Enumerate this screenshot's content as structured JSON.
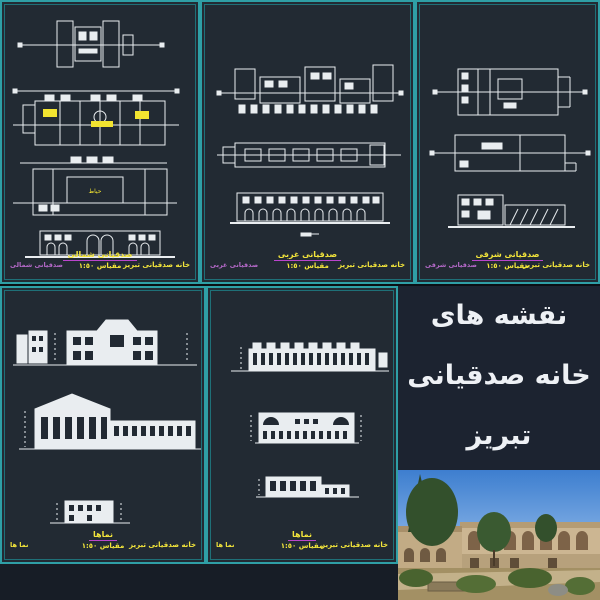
{
  "poster": {
    "line1": "نقشه های",
    "line2": "خانه صدقیانی",
    "line3": "تبریز"
  },
  "panels": [
    {
      "title": "صدقیانی شمالی",
      "scale": "مقياس ١:٥٠",
      "corner_right": "خانه صدقیانی تبریز",
      "corner_left": "صدقیانی شمالی",
      "room_label": "حیاط"
    },
    {
      "title": "صدقیانی غربی",
      "scale": "مقياس ١:٥٠",
      "corner_right": "خانه صدقیانی تبریز",
      "corner_left": "صدقیانی غربی"
    },
    {
      "title": "صدقیانی شرقی",
      "scale": "مقياس ١:٥٠",
      "corner_right": "خانه صدقیانی تبریز",
      "corner_left": "صدقیانی شرقی"
    },
    {
      "title": "نماها",
      "scale": "مقياس ١:٥٠",
      "corner_right": "خانه صدقیانی تبریز",
      "corner_left": "نما ها"
    },
    {
      "title": "نماها",
      "scale": "مقياس ١:٥٠",
      "corner_right": "خانه صدقیانی تبریز",
      "corner_left": "نما ها"
    }
  ],
  "colors": {
    "border_cyan": "#2f9fa6",
    "panel_bg": "#222a33",
    "title_yellow": "#f3e53b",
    "underline_magenta": "#bb44cc",
    "corner_magenta": "#b469c8",
    "poster_bg": "#1c2330",
    "poster_text": "#eef1f5",
    "drawing_white": "#e9edf0",
    "highlight_yellow": "#f2e430"
  }
}
